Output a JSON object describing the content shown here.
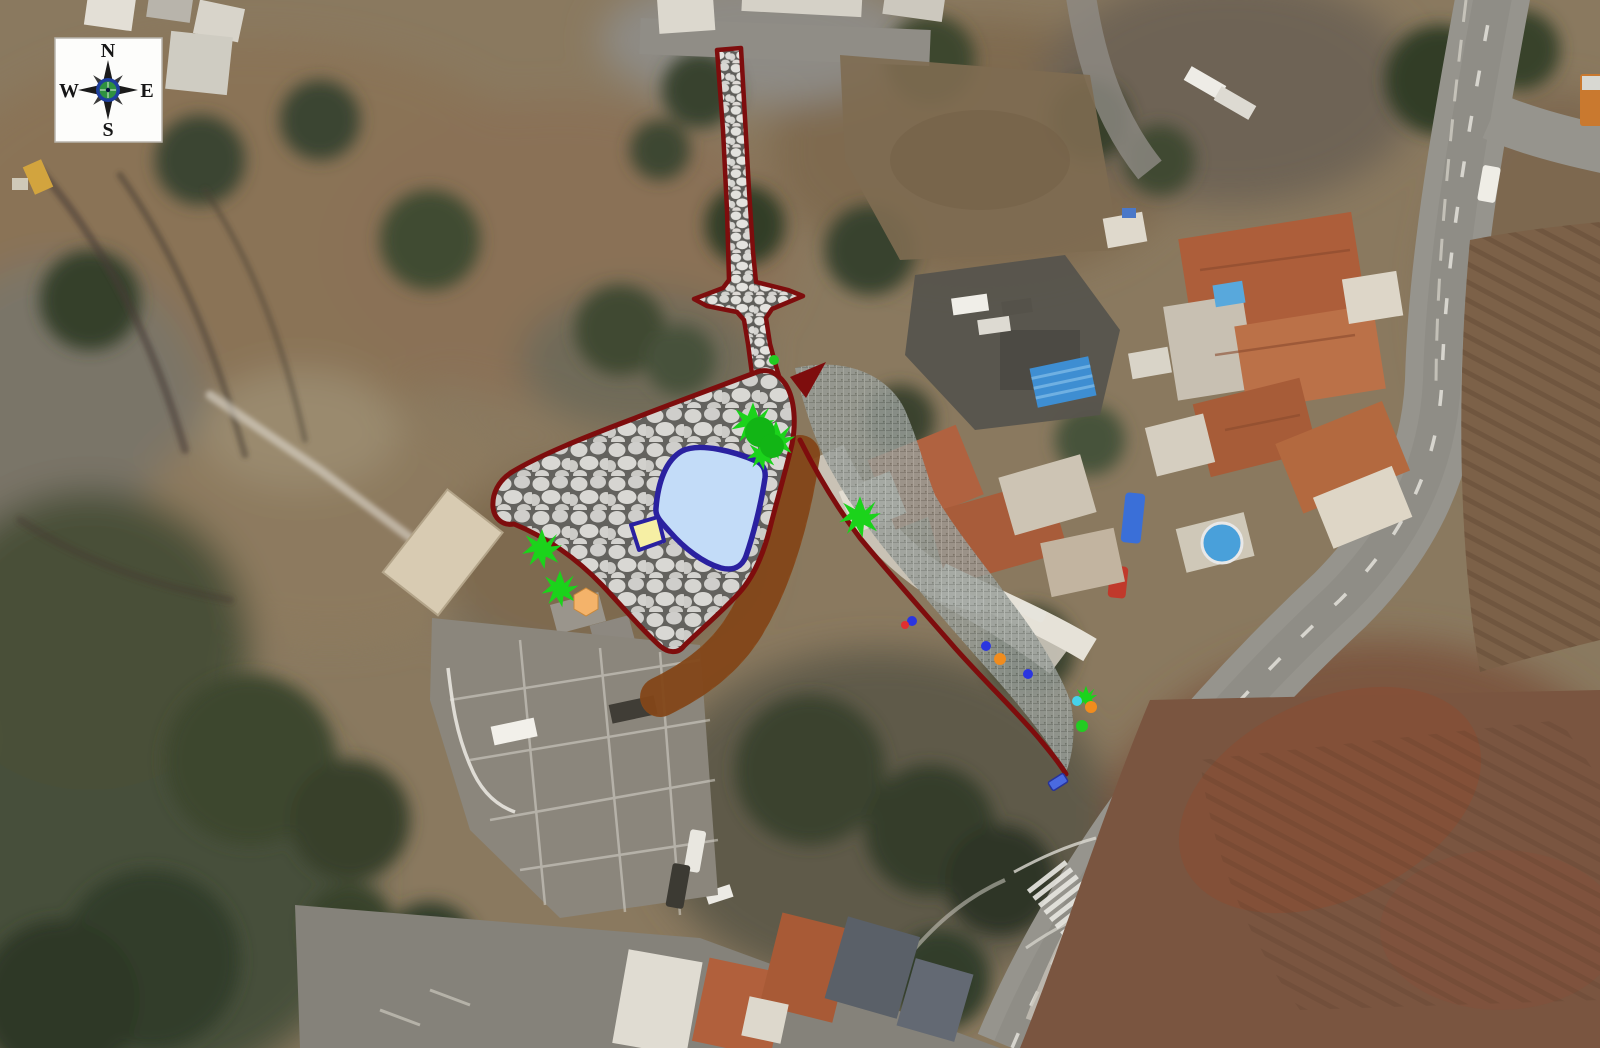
{
  "document": {
    "type": "aerial-site-plan",
    "title": "Landscaping site plan overlaid on aerial photograph"
  },
  "compass": {
    "n": "N",
    "e": "E",
    "s": "S",
    "w": "W"
  },
  "colors": {
    "plan_border": "#7e0d0d",
    "pond_fill": "#c3dcf8",
    "pond_border": "#2a21a0",
    "beach_fill": "#f6efa4",
    "tree_green": "#1bd31b",
    "tree_green_dark": "#12b515",
    "dot_green": "#22cc22",
    "dot_blue": "#2a35e0",
    "dot_red": "#e03030",
    "dot_orange": "#f08c1e",
    "dot_cyan": "#46d2ea",
    "parasol": "#f4b36a",
    "bench_blue": "#4a6ae0",
    "dirt_path": "#8a4a1a"
  },
  "overlay": {
    "plaza": {
      "label": "cobblestone plaza"
    },
    "pond": {
      "label": "pond"
    },
    "markers": {
      "trees": [
        {
          "x": 542,
          "y": 549,
          "s": 1.25
        },
        {
          "x": 560,
          "y": 589,
          "s": 1.15
        },
        {
          "x": 753,
          "y": 424,
          "s": 1.35
        },
        {
          "x": 776,
          "y": 440,
          "s": 1.2
        },
        {
          "x": 762,
          "y": 455,
          "s": 0.95
        },
        {
          "x": 860,
          "y": 517,
          "s": 1.3
        },
        {
          "x": 1086,
          "y": 697,
          "s": 0.7
        }
      ],
      "tree_blobs": [
        {
          "x": 760,
          "y": 432,
          "r": 15
        },
        {
          "x": 772,
          "y": 446,
          "r": 12
        }
      ],
      "dots_green": [
        {
          "x": 774,
          "y": 360,
          "r": 5
        },
        {
          "x": 1082,
          "y": 726,
          "r": 6
        }
      ],
      "dots_blue": [
        {
          "x": 912,
          "y": 621,
          "r": 5
        },
        {
          "x": 986,
          "y": 646,
          "r": 5
        },
        {
          "x": 1028,
          "y": 674,
          "r": 5
        }
      ],
      "dots_red": [
        {
          "x": 905,
          "y": 625,
          "r": 4
        }
      ],
      "dots_orange": [
        {
          "x": 1000,
          "y": 659,
          "r": 6
        },
        {
          "x": 1091,
          "y": 707,
          "r": 6
        }
      ],
      "dots_cyan": [
        {
          "x": 1077,
          "y": 701,
          "r": 5
        }
      ],
      "parasol": [
        {
          "x": 586,
          "y": 602
        }
      ],
      "bench": [
        {
          "x": 1058,
          "y": 782
        }
      ]
    }
  }
}
